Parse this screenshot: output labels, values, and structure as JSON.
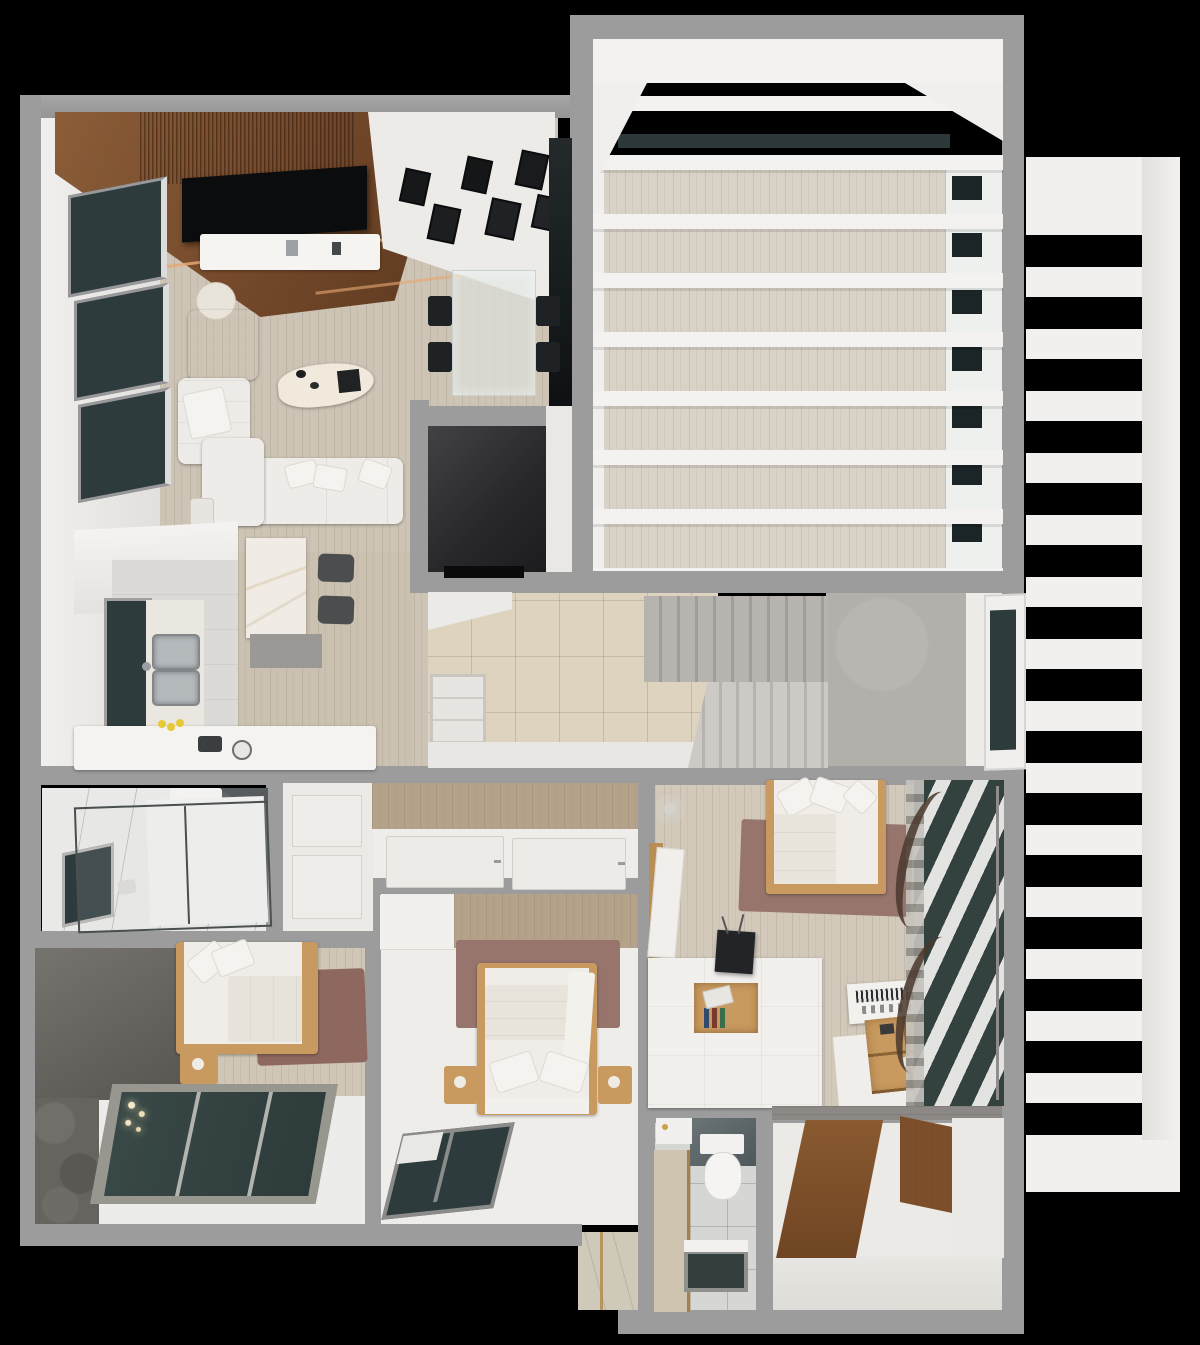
{
  "scene": {
    "kind": "3d-floor-plan-render",
    "view": "top-down dollhouse",
    "rooms": [
      {
        "name": "living-room",
        "contents": [
          "walnut-slat-ceiling",
          "led-strips",
          "wall-tv",
          "media-console",
          "gallery-photo-wall",
          "black-armchair",
          "white-lounge-chair",
          "l-shaped-white-sofa",
          "travertine-coffee-table",
          "round-side-table",
          "three-ribbon-windows"
        ]
      },
      {
        "name": "dining-area",
        "contents": [
          "glass-dining-table",
          "four-black-chairs",
          "dark-curtain-wall"
        ]
      },
      {
        "name": "kitchen",
        "contents": [
          "l-counter",
          "double-stainless-sink",
          "backsplash-window",
          "marble-island",
          "two-bar-stools",
          "lemons",
          "small-appliances"
        ]
      },
      {
        "name": "terrace",
        "contents": [
          "white-pergola-beams",
          "wood-deck",
          "glass-panel",
          "punched-white-wall"
        ]
      },
      {
        "name": "stair-hall",
        "contents": [
          "dark-volume",
          "travertine-floor",
          "upper-flight",
          "lower-flight",
          "concrete-landing",
          "folding-glass-door"
        ]
      },
      {
        "name": "bathroom",
        "contents": [
          "glass-shower",
          "toilet",
          "window",
          "dark-stone-wall"
        ]
      },
      {
        "name": "wardrobe-hall",
        "contents": [
          "paneled-wardrobe",
          "wood-plank-wall",
          "recessed-floor-panels"
        ]
      },
      {
        "name": "bedroom-left",
        "contents": [
          "bed",
          "nightstand",
          "mauve-rug",
          "dark-stone-wall",
          "chandelier",
          "sloped-glazing"
        ]
      },
      {
        "name": "bedroom-center",
        "contents": [
          "bed",
          "two-nightstands",
          "mauve-rug",
          "wood-plank-wall",
          "closet",
          "corner-window"
        ]
      },
      {
        "name": "bedroom-right",
        "contents": [
          "bed",
          "mauve-rug",
          "dresser-island",
          "book-cubby",
          "small-tv",
          "keyboard-shelf",
          "wood-organizer-trays",
          "sheer-curtain-windows",
          "entry-door",
          "dried-plant"
        ]
      },
      {
        "name": "wc",
        "contents": [
          "toilet",
          "skylight",
          "vanity",
          "dark-marble-band"
        ]
      },
      {
        "name": "dressing-hall",
        "contents": [
          "walnut-floor-runner",
          "walnut-cabinet"
        ]
      },
      {
        "name": "louver-screen",
        "contents": [
          "horizontal-slats",
          "side-rail",
          "top-band",
          "bottom-band"
        ]
      },
      {
        "name": "entry-alcove",
        "contents": [
          "beige-tile",
          "brass-strip"
        ]
      }
    ]
  },
  "palette": {
    "background": "#000000",
    "wall": "#9c9c9c",
    "white": "#f2f1ef",
    "whiteDim": "#e7e5e2",
    "wallFace": "#edecE9",
    "floorWood": "#cdc4b5",
    "kitchenWood": "#cbc1b0",
    "terraceWood": "#d9d2c7",
    "bedroomWood": "#d2c9bb",
    "walnut": "#74482a",
    "walnutLight": "#8a5a30",
    "lightWood": "#c89a5f",
    "plankWall": "#b5a28b",
    "glassDark": "#2e3b3d",
    "glassPane": "#33413f",
    "charcoal": "#29292c",
    "tvBlack": "#0b0c0e",
    "travertine": "#ded3bf",
    "stairTread": "#b7b4af",
    "stairTreadLight": "#cdcac5",
    "landing": "#b3b0ab",
    "stoneDark": "#67645f",
    "bathStone": "#565b5d",
    "rug": "#97756d",
    "rugDark": "#8e685f",
    "marble": "#f0ece5",
    "steel": "#b4b9bc",
    "lemon": "#e6c937",
    "led": "#e8a873",
    "curtainBrown": "#4a382c",
    "sheer": "#c6c3be"
  }
}
